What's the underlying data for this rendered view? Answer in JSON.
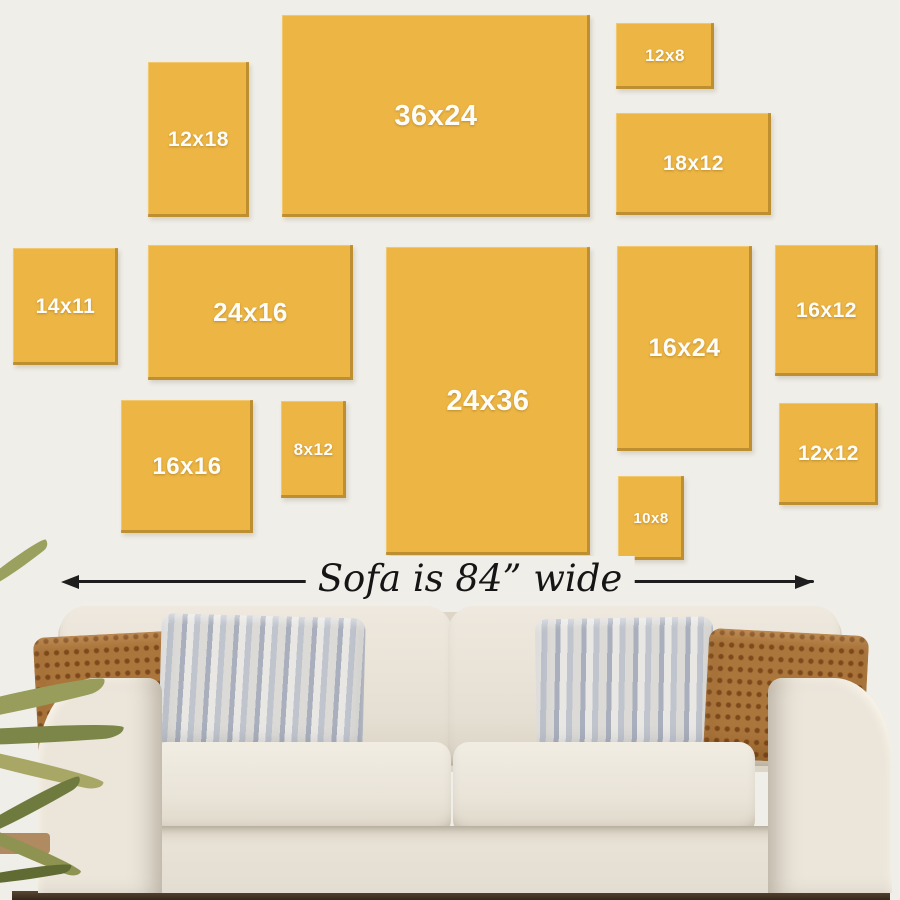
{
  "infographic": {
    "canvas_sizes": [
      {
        "label": "12x18"
      },
      {
        "label": "36x24"
      },
      {
        "label": "12x8"
      },
      {
        "label": "18x12"
      },
      {
        "label": "14x11"
      },
      {
        "label": "24x16"
      },
      {
        "label": "24x36"
      },
      {
        "label": "16x24"
      },
      {
        "label": "16x12"
      },
      {
        "label": "16x16"
      },
      {
        "label": "8x12"
      },
      {
        "label": "10x8"
      },
      {
        "label": "12x12"
      }
    ],
    "sofa_width_label": "Sofa is 84” wide"
  },
  "colors": {
    "wall": "#f0eee8",
    "canvas": "#ecb544",
    "canvas_edge": "#997021",
    "canvas_label": "#fdfcf8",
    "arrow": "#1e1e1e",
    "sofa_fabric": "#e9e3d8",
    "pillow_rust": "#ab763c",
    "pillow_stripe_light": "#e8e7e4",
    "pillow_stripe_dark": "#a9afbc",
    "plant_olive": "#8f9351",
    "floor_shadow": "#33271b"
  }
}
